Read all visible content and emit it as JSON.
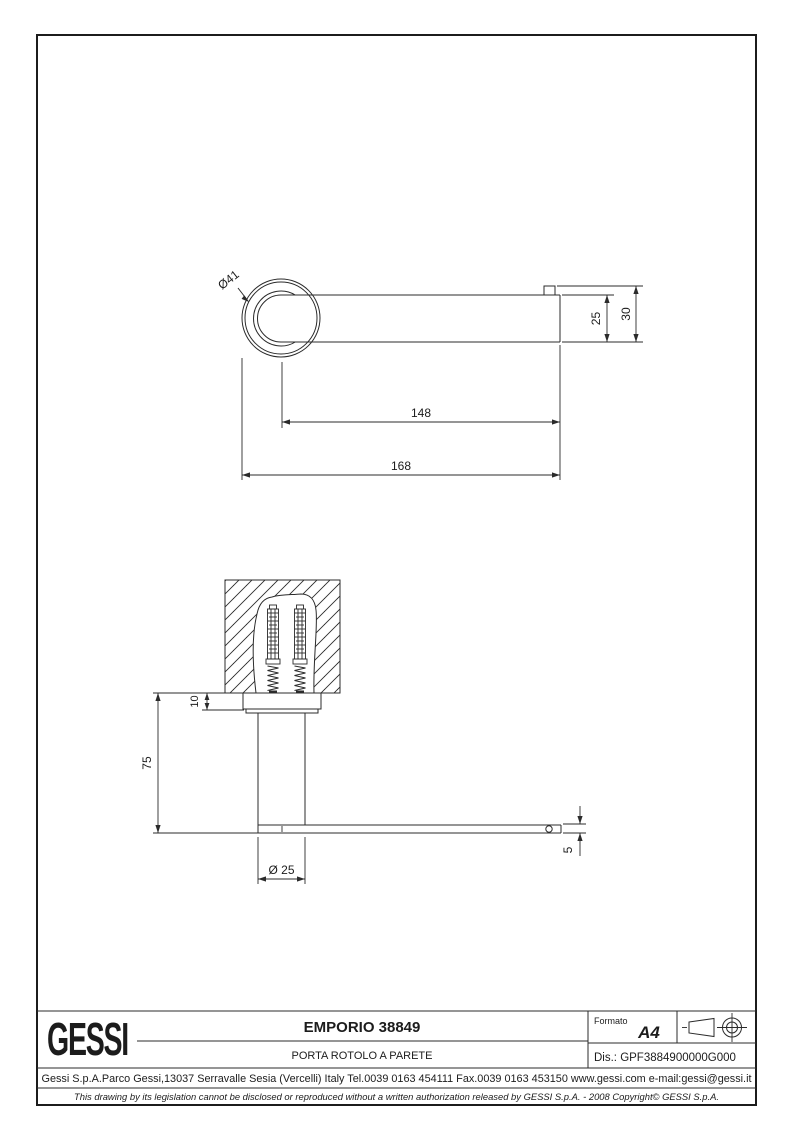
{
  "title_block": {
    "logo_text": "GESSI",
    "product_code_title": "EMPORIO 38849",
    "product_description": "PORTA ROTOLO A PARETE",
    "formato_label": "Formato",
    "formato_value": "A4",
    "drawing_number": "Dis.: GPF3884900000G000",
    "company_info": "Gessi S.p.A.Parco Gessi,13037 Serravalle Sesia (Vercelli) Italy Tel.0039 0163 454111 Fax.0039 0163 453150 www.gessi.com e-mail:gessi@gessi.it",
    "legal_notice": "This drawing by its legislation cannot be disclosed or reproduced without a written authorization released by GESSI S.p.A. - 2008 Copyright© GESSI S.p.A.",
    "projection_icons": [
      "first-angle-cone",
      "first-angle-target"
    ]
  },
  "front_view": {
    "flange_diameter": "Ø41",
    "bar_height": "25",
    "end_height": "30",
    "length_from_axis": "148",
    "overall_length": "168"
  },
  "side_view": {
    "flange_thickness": "10",
    "height": "75",
    "post_diameter": "Ø 25",
    "bar_thickness": "5"
  },
  "colors": {
    "line": "#2b2b2b",
    "paper": "#ffffff"
  }
}
